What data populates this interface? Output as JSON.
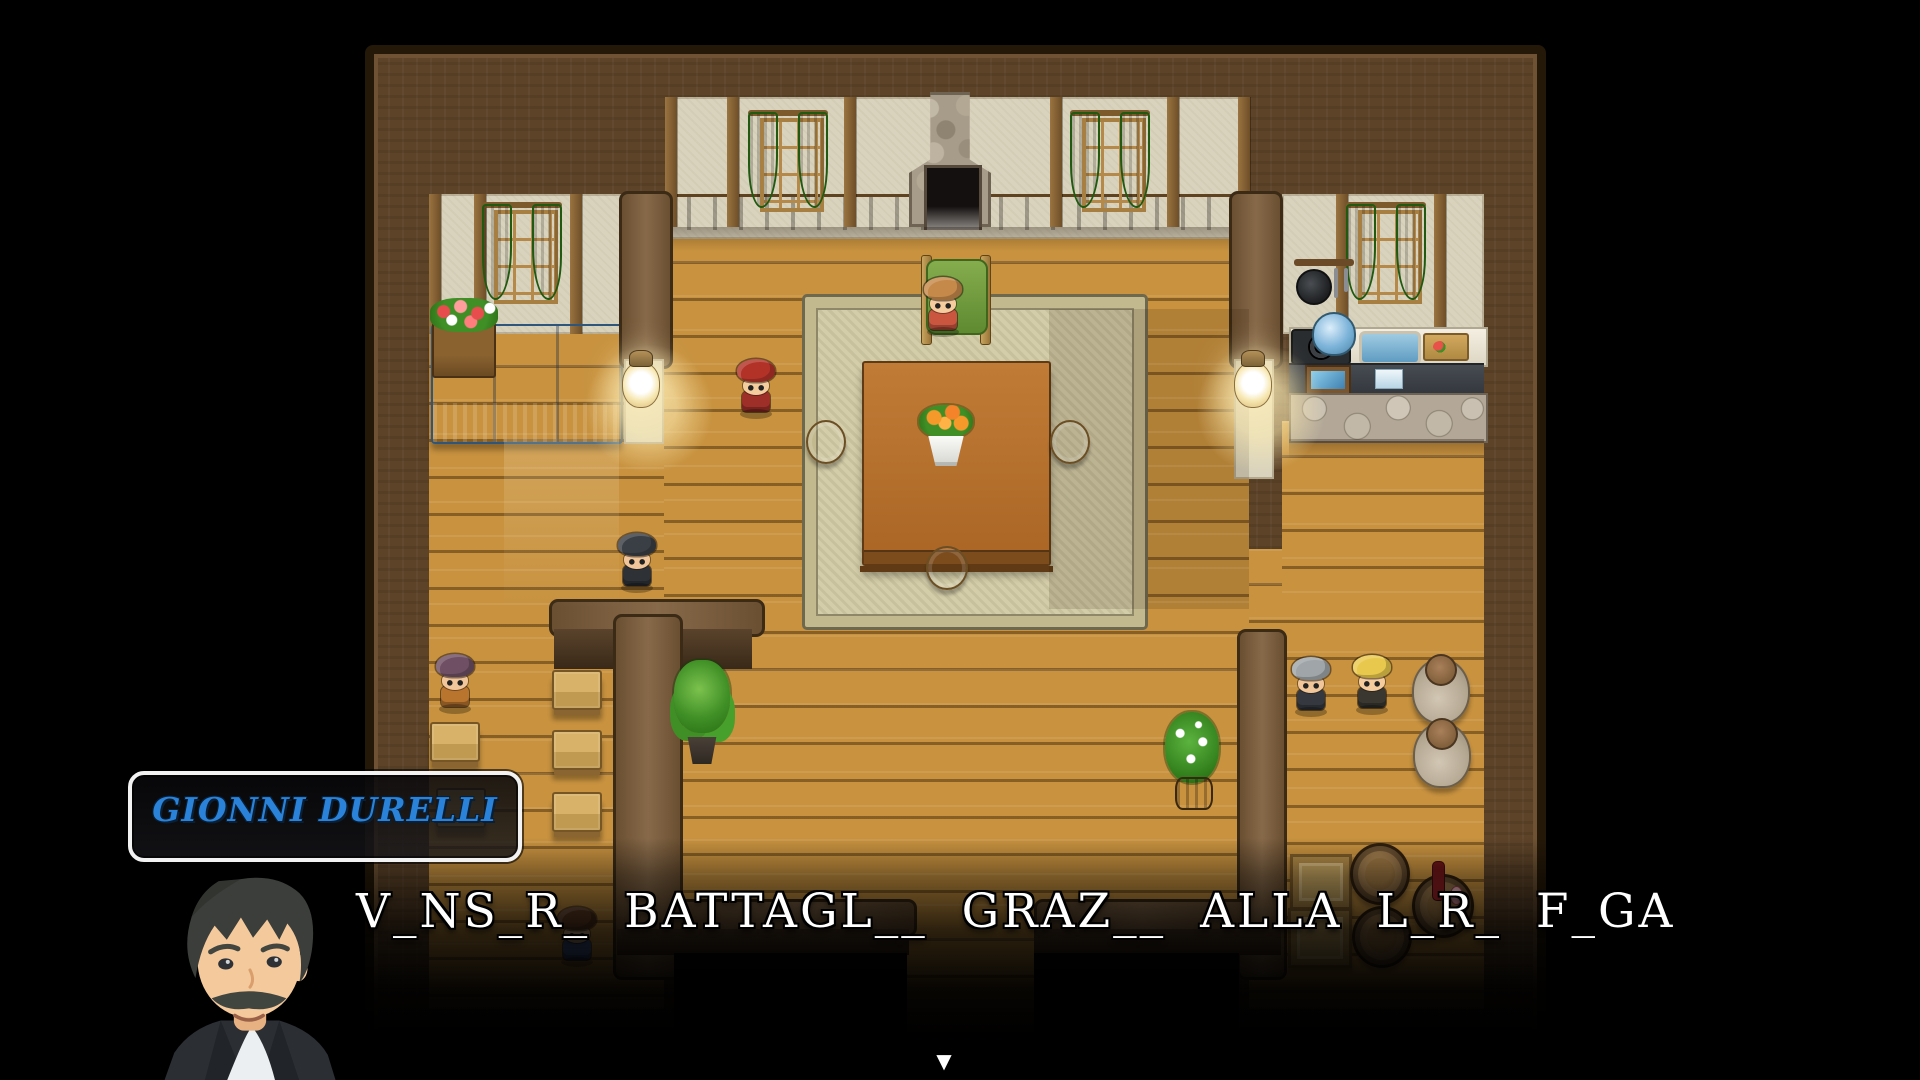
{
  "theme": {
    "frame": "#5d4328",
    "floor": "#c8923f",
    "wall": "#d9d3bd",
    "wallcap": "#7d5d3a",
    "rug": "#d4cda9",
    "rugBorder": "#c3b98e",
    "accentBlue": "#2b82d9"
  },
  "dialogue": {
    "speaker": "GIONNI DURELLI",
    "speaker_color": "#2b82d9",
    "text": "V_NS_R_ BATTAGL__ GRAZ__ ALLA L_R_ F_GA",
    "continue_indicator": "▼",
    "portrait_character": "gionni-durelli"
  },
  "scene": {
    "type": "rpg-house-interior",
    "npcs": [
      {
        "id": "seated-villager-girl",
        "x": 943,
        "y": 306,
        "hair": "#c5894a",
        "skin": "#f5cc9e",
        "outfit": "#cb5640"
      },
      {
        "id": "red-armored-knight",
        "x": 756,
        "y": 388,
        "hair": "#b23228",
        "skin": "#f5cc9e",
        "outfit": "#9e2f28"
      },
      {
        "id": "dark-haired-man",
        "x": 637,
        "y": 562,
        "hair": "#3a3f45",
        "skin": "#f0c69a",
        "outfit": "#2e3237"
      },
      {
        "id": "purple-haired-villager",
        "x": 455,
        "y": 683,
        "hair": "#6f4f63",
        "skin": "#f0c69a",
        "outfit": "#b9742e"
      },
      {
        "id": "gray-haired-gentleman",
        "x": 1311,
        "y": 686,
        "hair": "#9fa5a9",
        "skin": "#f0c69a",
        "outfit": "#35393f"
      },
      {
        "id": "blond-adventurer",
        "x": 1372,
        "y": 684,
        "hair": "#e9c94d",
        "skin": "#f5cc9e",
        "outfit": "#3a3731"
      },
      {
        "id": "blue-armored-knight",
        "x": 577,
        "y": 936,
        "hair": "#6e4326",
        "skin": "#f0c69a",
        "outfit": "#4a69a6"
      }
    ],
    "furniture": [
      {
        "type": "stool",
        "x": 806,
        "y": 420,
        "w": 36,
        "h": 40
      },
      {
        "type": "stool",
        "x": 1050,
        "y": 420,
        "w": 36,
        "h": 40
      },
      {
        "type": "stool",
        "x": 926,
        "y": 546,
        "w": 38,
        "h": 40
      },
      {
        "type": "flowerpot",
        "x": 922,
        "y": 408,
        "w": 48,
        "h": 58
      },
      {
        "type": "bench",
        "x": 430,
        "y": 722,
        "w": 46,
        "h": 36
      },
      {
        "type": "bench",
        "x": 436,
        "y": 788,
        "w": 46,
        "h": 36
      },
      {
        "type": "bench",
        "x": 552,
        "y": 670,
        "w": 46,
        "h": 36
      },
      {
        "type": "bench",
        "x": 552,
        "y": 730,
        "w": 46,
        "h": 36
      },
      {
        "type": "bench",
        "x": 552,
        "y": 792,
        "w": 46,
        "h": 36
      },
      {
        "type": "plant-tree",
        "x": 672,
        "y": 660,
        "w": 60,
        "h": 104
      },
      {
        "type": "plant-flower",
        "x": 1164,
        "y": 712,
        "w": 56,
        "h": 98
      },
      {
        "type": "jar",
        "x": 1412,
        "y": 658,
        "w": 54,
        "h": 62
      },
      {
        "type": "jar",
        "x": 1413,
        "y": 722,
        "w": 54,
        "h": 62
      },
      {
        "type": "crate",
        "x": 1290,
        "y": 854,
        "w": 56,
        "h": 50
      },
      {
        "type": "crate",
        "x": 1288,
        "y": 908,
        "w": 58,
        "h": 54
      },
      {
        "type": "barrel",
        "x": 1350,
        "y": 843,
        "w": 54,
        "h": 56
      },
      {
        "type": "barrel",
        "x": 1352,
        "y": 906,
        "w": 54,
        "h": 56
      },
      {
        "type": "barrel-wine",
        "x": 1412,
        "y": 874,
        "w": 56,
        "h": 58
      },
      {
        "type": "lamp",
        "x": 622,
        "y": 350,
        "w": 36,
        "h": 58
      },
      {
        "type": "lamp",
        "x": 1234,
        "y": 350,
        "w": 36,
        "h": 58
      }
    ]
  }
}
